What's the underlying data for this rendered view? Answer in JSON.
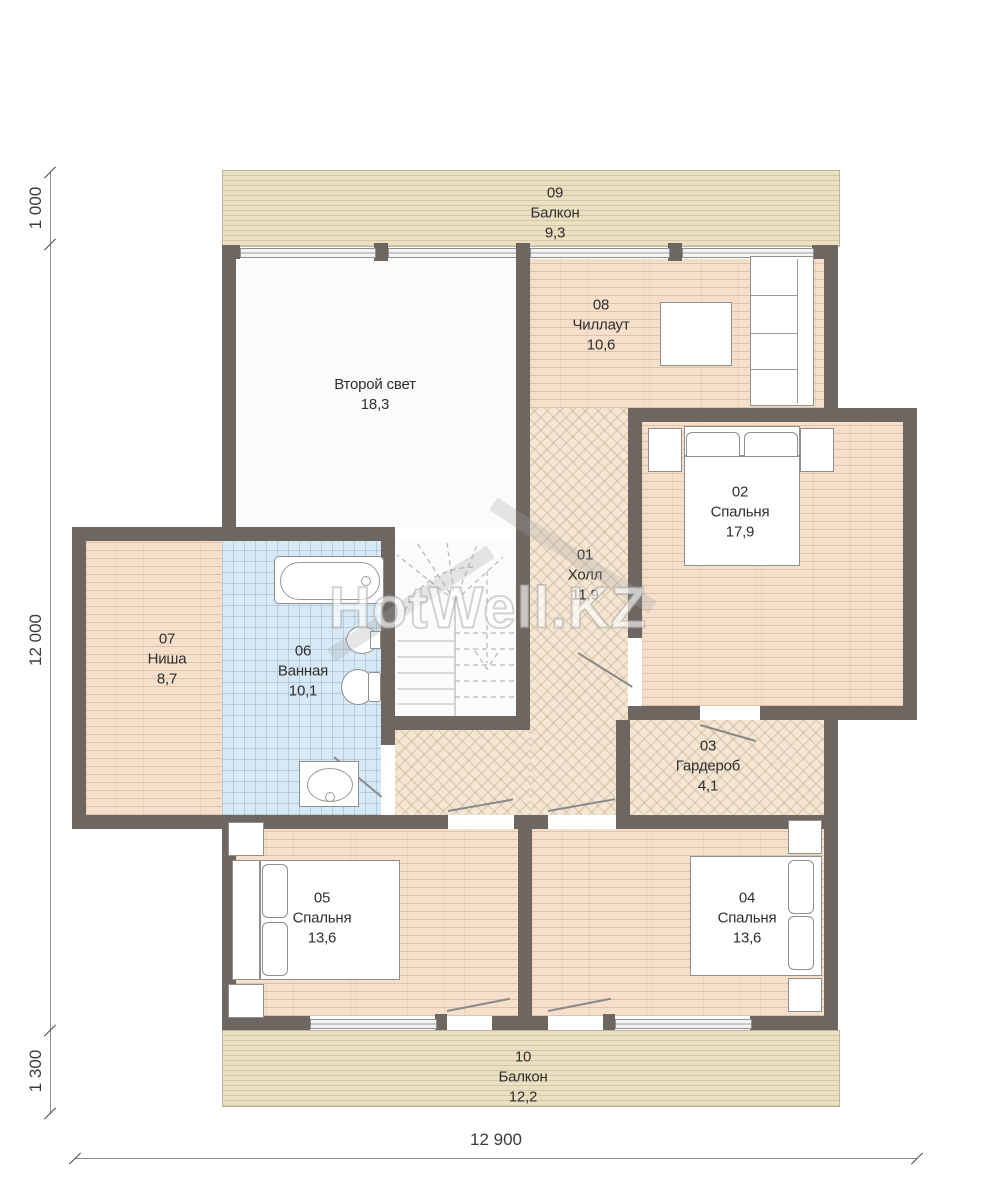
{
  "plan": {
    "watermark": "HotWell.KZ",
    "rooms": {
      "second_light": {
        "name": "Второй свет",
        "area": "18,3"
      },
      "r01": {
        "id": "01",
        "name": "Холл",
        "area": "11,9"
      },
      "r02": {
        "id": "02",
        "name": "Спальня",
        "area": "17,9"
      },
      "r03": {
        "id": "03",
        "name": "Гардероб",
        "area": "4,1"
      },
      "r04": {
        "id": "04",
        "name": "Спальня",
        "area": "13,6"
      },
      "r05": {
        "id": "05",
        "name": "Спальня",
        "area": "13,6"
      },
      "r06": {
        "id": "06",
        "name": "Ванная",
        "area": "10,1"
      },
      "r07": {
        "id": "07",
        "name": "Ниша",
        "area": "8,7"
      },
      "r08": {
        "id": "08",
        "name": "Чиллаут",
        "area": "10,6"
      },
      "r09": {
        "id": "09",
        "name": "Балкон",
        "area": "9,3"
      },
      "r10": {
        "id": "10",
        "name": "Балкон",
        "area": "12,2"
      }
    },
    "dimensions": {
      "balcony_top": "1 000",
      "house_height": "12 000",
      "balcony_bottom": "1 300",
      "house_width": "12 900"
    },
    "colors": {
      "wall": "#6e6660",
      "wood_floor": "#f6e0cb",
      "parquet": "#f3e6d2",
      "bath_tile": "#d6e9f4",
      "deck": "#ece0c3"
    }
  }
}
